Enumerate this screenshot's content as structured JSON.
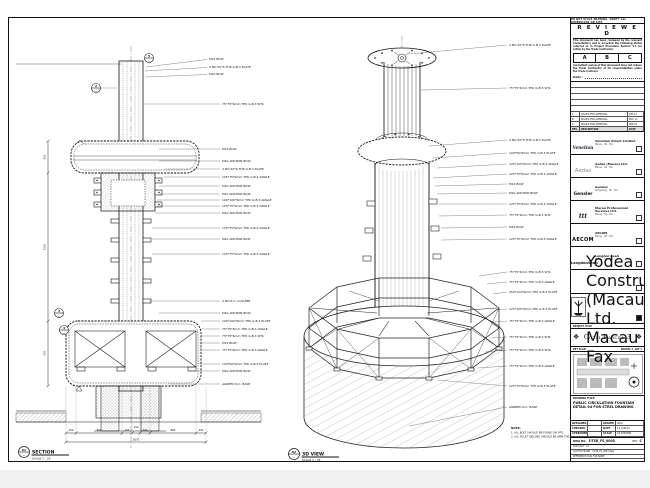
{
  "sheet": {
    "top_note": "DO NOT SCALE DRAWING. VERIFY ALL DIMENSIONS ON SITE.",
    "reviewed": {
      "title": "R E V I E W E D",
      "para1": "This document has been reviewed by the relevant Consultant(s) and is accorded the following status referred to in Project Procedure Section 5.4 for action by the Trade Contractor.",
      "statuses": [
        "A",
        "B",
        "C"
      ],
      "para2": "Consultant review of this document does not relieve the Trade Contractor of its responsibilities under the Trade Contract.",
      "date_label": "Date :"
    },
    "revisions": {
      "rows": [
        [
          "C",
          "ISSUED FOR APPROVAL",
          "JUN 13"
        ],
        [
          "B",
          "ISSUED FOR APPROVAL",
          "MAY 13"
        ],
        [
          "A",
          "ISSUED FOR APPROVAL",
          "APR 13"
        ]
      ],
      "footer": [
        "REV",
        "DESCRIPTION",
        "DATE"
      ]
    },
    "consultants": [
      {
        "logo": "Venetian",
        "name": "Venetian Orient Limited",
        "addr": "Macau · Tel · Fax"
      },
      {
        "logo": "Aedas",
        "name": "Aedas (Macau) Ltd.",
        "addr": "Macau · Tel · Fax"
      },
      {
        "logo": "Gensler",
        "name": "Gensler",
        "addr": "Hong Kong · Tel · Fax"
      },
      {
        "logo": "ttt",
        "name": "Macau Professional Services Ltd.",
        "addr": "Macau · Tel · Fax"
      },
      {
        "logo": "AECOM",
        "name": "AECOM",
        "addr": "Macau · Tel · Fax"
      },
      {
        "logo": "LangdonSeah",
        "name": "Langdon Seah",
        "addr": "Macau · Tel · Fax"
      }
    ],
    "contractor": {
      "name": "Yodea Construction (Macau) Co., Ltd.",
      "addr": "Macau · Tel · Fax"
    },
    "project_label": "PROJECT TITLE",
    "project_title": "Cotai Parcel 3",
    "key_plan": {
      "label": "KEY PLAN",
      "right": "PARCEL 3, LOT 2"
    },
    "drawing_title_label": "DRAWING TITLE:",
    "drawing_title": "PUBLIC CIRCULATION FOUNTAIN DETAIL 04 FOR STEEL DRAWING",
    "credits": [
      [
        "DESIGNED",
        "-",
        "DRAWN",
        "LWO"
      ],
      [
        "CHECKED",
        "-",
        "DATE",
        "14-JUN-13"
      ],
      [
        "APPROVED",
        "-",
        "SCALE",
        "AS SHOWN"
      ]
    ],
    "dwg": {
      "label": "DWG NO.",
      "no": "3-TSR_FS_0003",
      "rev_label": "REV",
      "rev": "C"
    },
    "cad_rows": [
      "CAD PLOT : A1",
      "CAD FILE NAME : 3-TSR_FS_0003.dwg",
      "REFERENCE DWG FILE NAME"
    ]
  },
  "section_view": {
    "bubble": "01",
    "dash": "-",
    "label": "SECTION",
    "scale": "SCALE 1 : 25",
    "bubbles": [
      "5",
      "2",
      "3",
      "4"
    ],
    "top_annotations": [
      "M12 BOLT",
      "4 NO 50*6 THK G.B.3 PLATE",
      "M10 BOLT"
    ],
    "annotations": [
      "75*75*6mm THK G.B.3 SHS",
      "M12 BOLT",
      "M10 ANCHOR BOLT",
      "4 NO 50*6 THK G.B.3 PLATE",
      "125*75*6mm THK G.B.3 ANGLE",
      "M10 ANCHOR BOLT",
      "M10 ANCHOR BOLT",
      "100*100*6mm THK G.B.3 ANGLE",
      "125*75*6mm THK G.B.3 ANGLE",
      "M10 ANCHOR BOLT",
      "125*75*6mm THK G.B.3 ANGLE",
      "M10 ANCHOR BOLT",
      "125*75*6mm THK G.B.3 ANGLE",
      "4 NO R.C. COLUMN",
      "M10 ANCHOR BOLT",
      "100*100*6mm THK G.B.3 PLATE",
      "75*75*6mm THK G.B.3 ANGLE",
      "75*75*6mm THK G.B.3 SHS",
      "M12 BOLT",
      "75*75*6mm THK G.B.3 ANGLE",
      "100*50*6mm THK G.B.3 PLATE",
      "M10 ANCHOR BOLT",
      "AGREED R.C. BASE"
    ],
    "dims": [
      "200",
      "860",
      "200",
      "150",
      "200",
      "860",
      "200"
    ],
    "dim_total": "2670",
    "vdims": [
      "650",
      "1500",
      "650"
    ]
  },
  "view3d": {
    "bubble": "02",
    "dash": "-",
    "label": "3D VIEW",
    "scale": "SCALE 1 : 25",
    "annotations": [
      "4 NO 50*6 THK G.B.3 PLATE",
      "75*75*6mm THK G.B.3 SHS",
      "4 NO 50*6 THK G.B.3 PLATE",
      "100*50*6mm THK G.B.3 PLATE",
      "125*125*6mm THK G.B.3 ANGLE",
      "125*75*6mm THK G.B.3 ANGLE",
      "M12 BOLT",
      "M10 ANCHOR BOLT",
      "125*75*6mm THK G.B.3 ANGLE",
      "75*75*6mm THK G.B.3 SHS",
      "M12 BOLT",
      "125*75*6mm THK G.B.3 ANGLE",
      "75*75*6mm THK G.B.3 SHS",
      "75*75*6mm THK G.B.3 ANGLE",
      "450*120*6mm THK G.B.3 PLATE",
      "125*125*6mm THK G.B.3 PLATE",
      "75*75*6mm THK G.B.3 ANGLE",
      "75*75*6mm THK G.B.3 SHS",
      "75*75*6mm THK G.B.3 SHS",
      "75*75*6mm THK G.B.3 ANGLE",
      "125*75*6mm THK G.B.3 PLATE",
      "AGREED R.C. BASE"
    ],
    "note_title": "NOTE:",
    "notes": [
      "1. ALL BOLT SHOULD BE FIXING ON SITE.",
      "2. ALL FILLET WELDED SHOULD BE 6MM THK."
    ]
  }
}
